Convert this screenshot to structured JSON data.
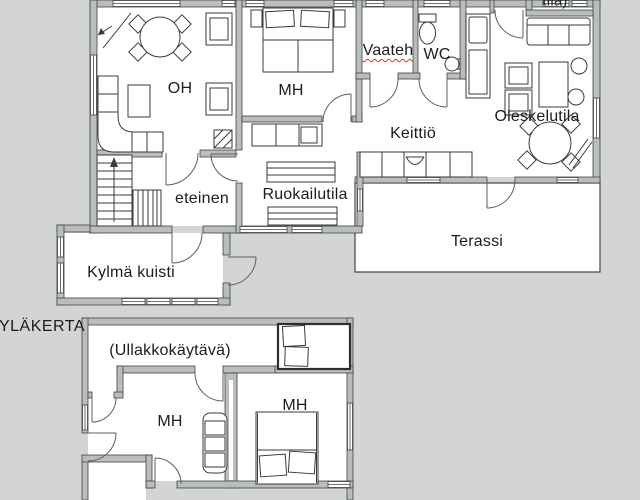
{
  "plan": {
    "ground_floor": {
      "rooms": {
        "living_room": "OH",
        "bedroom": "MH",
        "walk_in_closet": "Vaateh",
        "toilet": "WC",
        "kitchen": "Keittiö",
        "lounge": "Oleskelutila",
        "dining_area": "Ruokailutila",
        "hallway": "eteinen",
        "cold_porch": "Kylmä kuisti",
        "terrace": "Terassi",
        "cropped_room_label": "tila)"
      }
    },
    "upper_floor": {
      "section_label": "YLÄKERTA",
      "rooms": {
        "attic_corridor": "(Ullakkokäytävä)",
        "bedroom_left": "MH",
        "bedroom_right": "MH"
      }
    }
  },
  "colors": {
    "background": "#d2d5d4",
    "floor": "#ffffff",
    "wall_fill": "#b9bdbc",
    "wall_line": "#3f4443",
    "furniture_line": "#3a3a3a",
    "text": "#1c1c1c",
    "spellcheck_underline": "#e03423"
  }
}
